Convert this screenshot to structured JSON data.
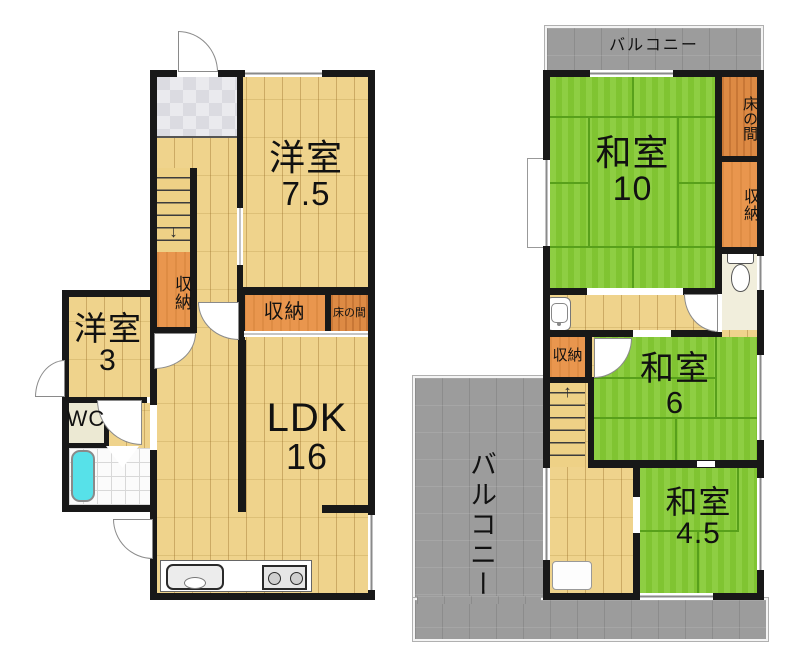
{
  "title": "2階建て住宅 間取り図",
  "floor1": {
    "yoshitsu75": {
      "name": "洋室",
      "size": "7.5"
    },
    "yoshitsu3": {
      "name": "洋室",
      "size": "3"
    },
    "ldk": {
      "name": "LDK",
      "size": "16"
    },
    "wc": "WC",
    "closet_stairs": "収納",
    "closet_center": "収納",
    "tokonoma": "床の間"
  },
  "floor2": {
    "washitsu10": {
      "name": "和室",
      "size": "10"
    },
    "washitsu6": {
      "name": "和室",
      "size": "6"
    },
    "washitsu45": {
      "name": "和室",
      "size": "4.5"
    },
    "tokonoma": "床の間",
    "closet_right": "収納",
    "closet_hall": "収納",
    "balcony_top": "バルコニー",
    "balcony_main": "バルコニー"
  },
  "icons": {
    "stairs_down_arrow": "↓",
    "stairs_up_arrow": "↑"
  },
  "colors": {
    "wall": "#181818",
    "wood_floor": "#eed186",
    "tatami_green": "#84ca33",
    "storage_orange": "#e9964e",
    "tokonoma_orange": "#dd8a44",
    "balcony_gray": "#9c9c9c",
    "bathtub_cyan": "#57e1e9"
  }
}
